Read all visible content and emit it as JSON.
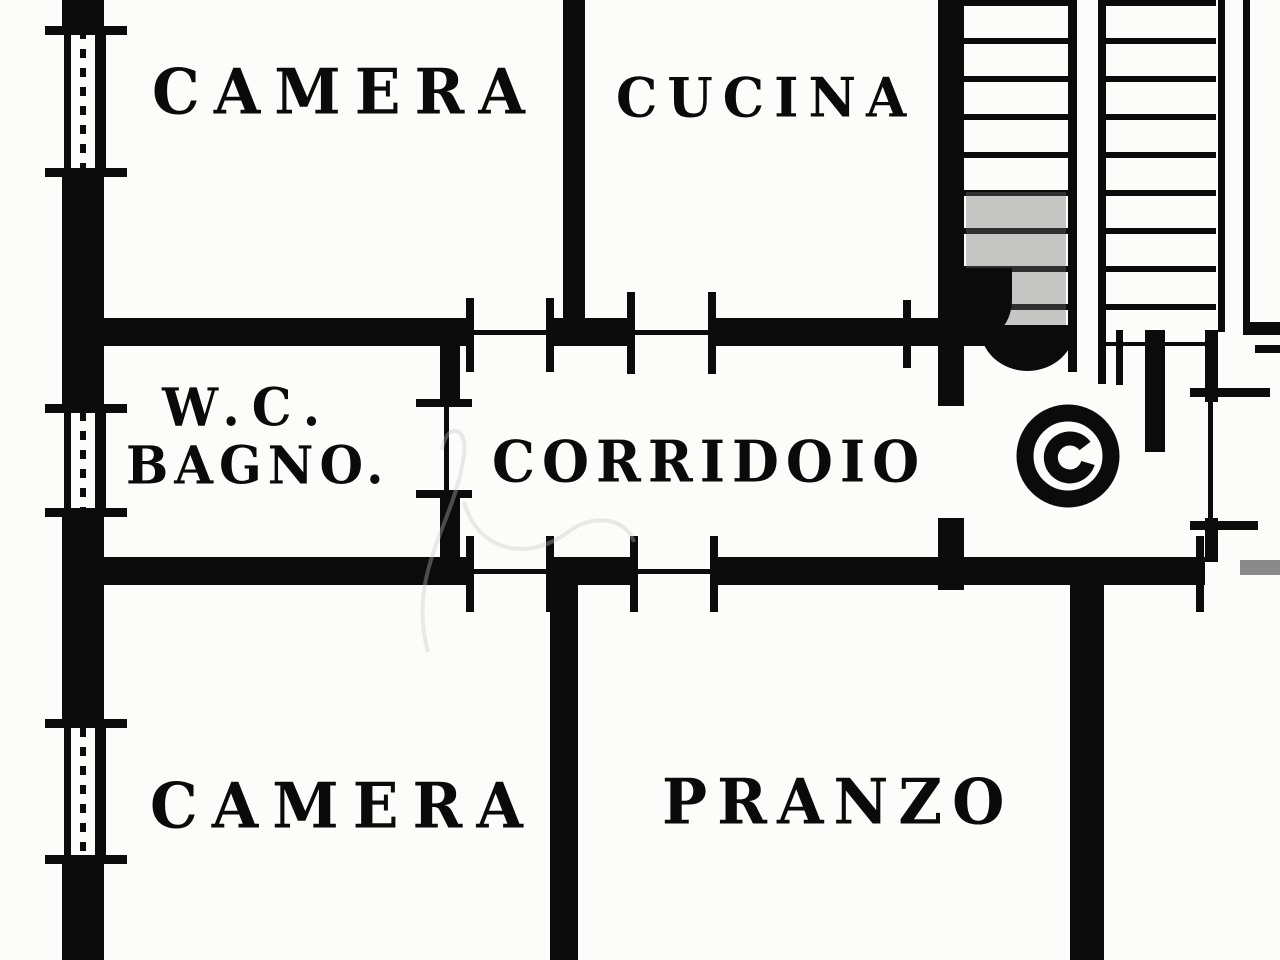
{
  "plan": {
    "rooms": [
      {
        "id": "camera-top",
        "label": "CAMERA"
      },
      {
        "id": "cucina",
        "label": "CUCINA"
      },
      {
        "id": "wc-bagno",
        "line1": "W.C.",
        "line2": "BAGNO."
      },
      {
        "id": "corridoio",
        "label": "CORRIDOIO"
      },
      {
        "id": "camera-bottom",
        "label": "CAMERA"
      },
      {
        "id": "pranzo",
        "label": "PRANZO"
      }
    ],
    "symbols": [
      {
        "id": "staircase-icon",
        "meaning": "double-flight staircase with treads"
      },
      {
        "id": "elevator-spiral-icon",
        "meaning": "circular spiral symbol on stair landing"
      },
      {
        "id": "window-icon",
        "meaning": "triple-line window in left exterior wall"
      }
    ],
    "colors": {
      "ink": "#0b0b0b",
      "paper": "#fcfcfb",
      "shade": "#8a8a8a",
      "watermark": "#c4c4c4"
    }
  }
}
